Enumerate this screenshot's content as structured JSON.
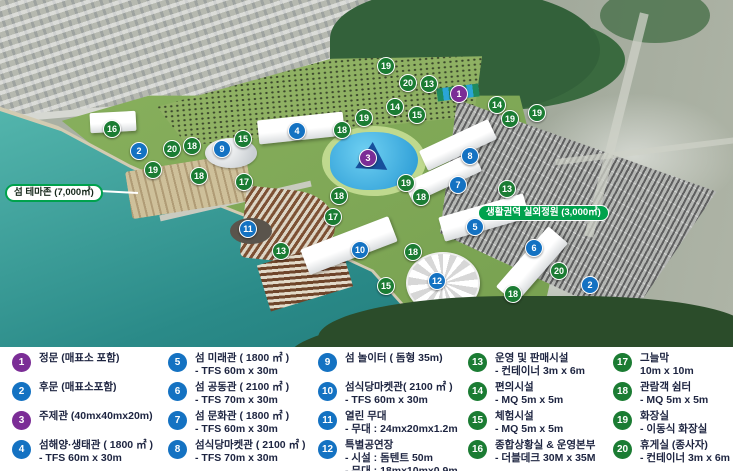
{
  "colors": {
    "purple": "#7b2d96",
    "blue": "#1472c2",
    "green": "#1b7c33",
    "label_green": "#00a24d"
  },
  "map": {
    "theme_label": {
      "text": "섬 테마존 (7,000㎡)"
    },
    "garden_label": {
      "text": "생활권역 실외정원 (3,000㎡)"
    },
    "markers": [
      {
        "n": "16",
        "c": "green",
        "x": 112,
        "y": 129
      },
      {
        "n": "2",
        "c": "blue",
        "x": 139,
        "y": 151
      },
      {
        "n": "20",
        "c": "green",
        "x": 172,
        "y": 149
      },
      {
        "n": "18",
        "c": "green",
        "x": 192,
        "y": 146
      },
      {
        "n": "9",
        "c": "blue",
        "x": 222,
        "y": 149
      },
      {
        "n": "15",
        "c": "green",
        "x": 243,
        "y": 139
      },
      {
        "n": "19",
        "c": "green",
        "x": 153,
        "y": 170
      },
      {
        "n": "18",
        "c": "green",
        "x": 199,
        "y": 176
      },
      {
        "n": "17",
        "c": "green",
        "x": 244,
        "y": 182
      },
      {
        "n": "4",
        "c": "blue",
        "x": 297,
        "y": 131
      },
      {
        "n": "18",
        "c": "green",
        "x": 342,
        "y": 130
      },
      {
        "n": "19",
        "c": "green",
        "x": 364,
        "y": 118
      },
      {
        "n": "3",
        "c": "purple",
        "x": 368,
        "y": 158
      },
      {
        "n": "19",
        "c": "green",
        "x": 386,
        "y": 66
      },
      {
        "n": "20",
        "c": "green",
        "x": 408,
        "y": 83
      },
      {
        "n": "13",
        "c": "green",
        "x": 429,
        "y": 84
      },
      {
        "n": "1",
        "c": "purple",
        "x": 459,
        "y": 94
      },
      {
        "n": "14",
        "c": "green",
        "x": 395,
        "y": 107
      },
      {
        "n": "15",
        "c": "green",
        "x": 417,
        "y": 115
      },
      {
        "n": "14",
        "c": "green",
        "x": 497,
        "y": 105
      },
      {
        "n": "19",
        "c": "green",
        "x": 510,
        "y": 119
      },
      {
        "n": "19",
        "c": "green",
        "x": 537,
        "y": 113
      },
      {
        "n": "8",
        "c": "blue",
        "x": 470,
        "y": 156
      },
      {
        "n": "7",
        "c": "blue",
        "x": 458,
        "y": 185
      },
      {
        "n": "19",
        "c": "green",
        "x": 406,
        "y": 183
      },
      {
        "n": "18",
        "c": "green",
        "x": 421,
        "y": 197
      },
      {
        "n": "13",
        "c": "green",
        "x": 507,
        "y": 189
      },
      {
        "n": "5",
        "c": "blue",
        "x": 475,
        "y": 227
      },
      {
        "n": "6",
        "c": "blue",
        "x": 534,
        "y": 248
      },
      {
        "n": "20",
        "c": "green",
        "x": 559,
        "y": 271
      },
      {
        "n": "2",
        "c": "blue",
        "x": 590,
        "y": 285
      },
      {
        "n": "18",
        "c": "green",
        "x": 513,
        "y": 294
      },
      {
        "n": "18",
        "c": "green",
        "x": 339,
        "y": 196
      },
      {
        "n": "17",
        "c": "green",
        "x": 333,
        "y": 217
      },
      {
        "n": "11",
        "c": "blue",
        "x": 248,
        "y": 229
      },
      {
        "n": "10",
        "c": "blue",
        "x": 360,
        "y": 250
      },
      {
        "n": "13",
        "c": "green",
        "x": 281,
        "y": 251
      },
      {
        "n": "18",
        "c": "green",
        "x": 413,
        "y": 252
      },
      {
        "n": "15",
        "c": "green",
        "x": 386,
        "y": 286
      },
      {
        "n": "12",
        "c": "blue",
        "x": 437,
        "y": 281
      }
    ]
  },
  "legend": {
    "items": [
      {
        "n": "1",
        "c": "purple",
        "title": "정문 (매표소 포함)",
        "details": []
      },
      {
        "n": "2",
        "c": "blue",
        "title": "후문 (매표소포함)",
        "details": []
      },
      {
        "n": "3",
        "c": "purple",
        "title": "주제관 (40mx40mx20m)",
        "details": []
      },
      {
        "n": "4",
        "c": "blue",
        "title": "섬해양·생태관 ( 1800 ㎡ )",
        "details": [
          "- TFS 60m x 30m"
        ]
      },
      {
        "n": "5",
        "c": "blue",
        "title": "섬 미래관 ( 1800 ㎡ )",
        "details": [
          "- TFS 60m x 30m"
        ]
      },
      {
        "n": "6",
        "c": "blue",
        "title": "섬 공동관 ( 2100 ㎡ )",
        "details": [
          "- TFS 70m x 30m"
        ]
      },
      {
        "n": "7",
        "c": "blue",
        "title": "섬 문화관 ( 1800 ㎡ )",
        "details": [
          "- TFS 60m x 30m"
        ]
      },
      {
        "n": "8",
        "c": "blue",
        "title": "섬식당마켓관 ( 2100 ㎡ )",
        "details": [
          "- TFS 70m x 30m"
        ]
      },
      {
        "n": "9",
        "c": "blue",
        "title": "섬 놀이터 ( 돔형 35m)",
        "details": []
      },
      {
        "n": "10",
        "c": "blue",
        "title": "섬식당마켓관( 2100 ㎡ )",
        "details": [
          "- TFS 60m x 30m"
        ]
      },
      {
        "n": "11",
        "c": "blue",
        "title": "열린 무대",
        "details": [
          "- 무대 : 24mx20mx1.2m"
        ]
      },
      {
        "n": "12",
        "c": "blue",
        "title": "특별공연장",
        "details": [
          "- 시설 : 돔텐트 50m",
          "- 무대 : 18mx10mx0.9m"
        ]
      },
      {
        "n": "13",
        "c": "green",
        "title": "운영 및 판매시설",
        "details": [
          "- 컨테이너 3m x 6m"
        ]
      },
      {
        "n": "14",
        "c": "green",
        "title": "편의시설",
        "details": [
          "- MQ 5m x 5m"
        ]
      },
      {
        "n": "15",
        "c": "green",
        "title": "체험시설",
        "details": [
          "- MQ 5m x 5m"
        ]
      },
      {
        "n": "16",
        "c": "green",
        "title": "종합상황실 & 운영본부",
        "details": [
          "- 더블데크 30M x 35M"
        ]
      },
      {
        "n": "17",
        "c": "green",
        "title": "그늘막",
        "details": [
          "10m x 10m"
        ]
      },
      {
        "n": "18",
        "c": "green",
        "title": "관람객 쉼터",
        "details": [
          "- MQ 5m x 5m"
        ]
      },
      {
        "n": "19",
        "c": "green",
        "title": "화장실",
        "details": [
          "- 이동식 화장실"
        ]
      },
      {
        "n": "20",
        "c": "green",
        "title": "휴게실 (종사자)",
        "details": [
          "- 컨테이너 3m x 6m"
        ]
      }
    ]
  }
}
